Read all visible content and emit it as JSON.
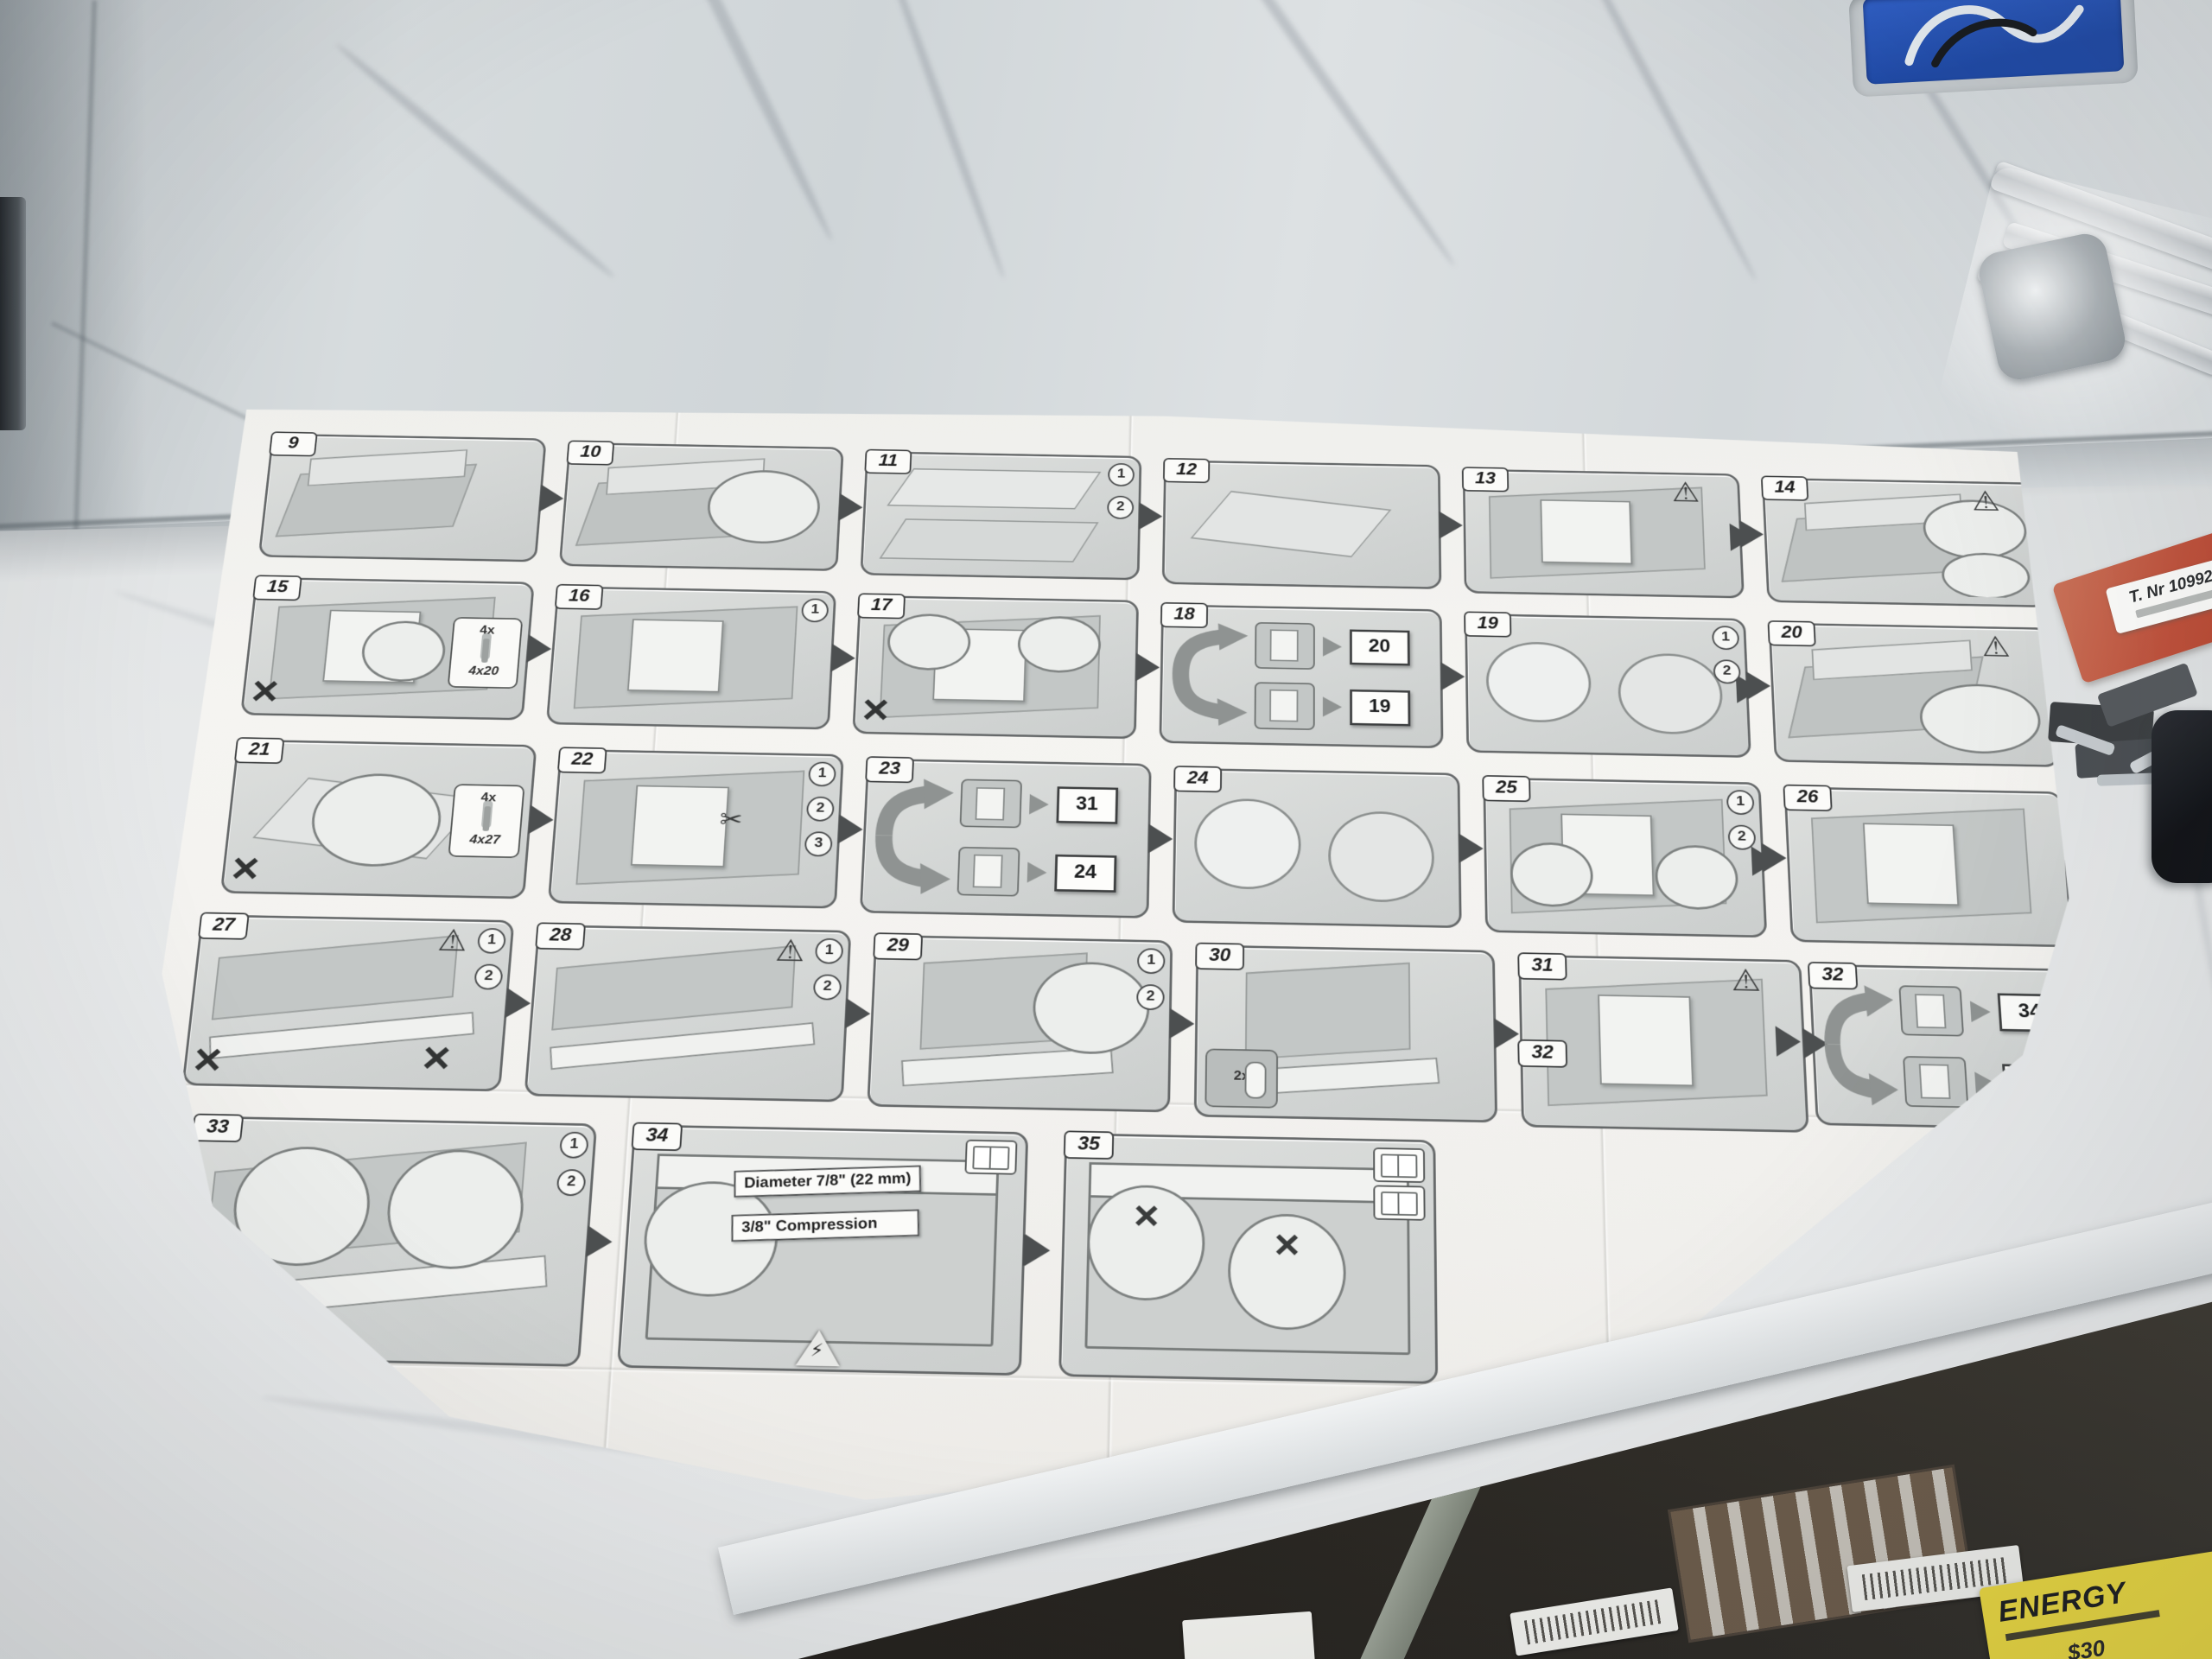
{
  "colors": {
    "outlet_blue": "#2b58c8",
    "red_card": "#c0503a",
    "energy_yellow": "#ecd93c",
    "paper": "#f3f2ef",
    "marble_base": "#dfe2e4"
  },
  "counter_items": {
    "parts_bag_label": "T. Nr 10992020",
    "energy_label_title": "ENERGY",
    "energy_label_price": "$30"
  },
  "instruction_sheet": {
    "panels": [
      {
        "id": "9",
        "row": 1,
        "pos": [
          60,
          50,
          350,
          175
        ],
        "variant": "iso"
      },
      {
        "id": "10",
        "row": 1,
        "pos": [
          445,
          55,
          350,
          175
        ],
        "variant": "iso",
        "circles": [
          {
            "r": 28,
            "x": 52,
            "y": 14,
            "w": 42,
            "h": 66
          }
        ]
      },
      {
        "id": "11",
        "row": 1,
        "pos": [
          830,
          60,
          350,
          175
        ],
        "variant": "boards",
        "steps": [
          "1",
          "2"
        ]
      },
      {
        "id": "12",
        "row": 1,
        "pos": [
          1215,
          65,
          350,
          175
        ],
        "variant": "flat"
      },
      {
        "id": "13",
        "row": 1,
        "pos": [
          1600,
          70,
          350,
          175
        ],
        "variant": "door",
        "warn": true
      },
      {
        "id": "14",
        "row": 1,
        "pos": [
          1985,
          75,
          350,
          175
        ],
        "variant": "iso",
        "warn": true,
        "circles": [
          {
            "x": 58,
            "y": 8,
            "w": 38,
            "h": 52
          },
          {
            "x": 64,
            "y": 58,
            "w": 32,
            "h": 40
          }
        ]
      },
      {
        "id": "15",
        "row": 2,
        "pos": [
          60,
          260,
          350,
          190
        ],
        "variant": "door",
        "xmark": 1,
        "screwbox": [
          "4x",
          "4x20"
        ],
        "circles": [
          {
            "x": 40,
            "y": 26,
            "w": 30,
            "h": 48
          }
        ]
      },
      {
        "id": "16",
        "row": 2,
        "pos": [
          445,
          265,
          350,
          190
        ],
        "variant": "door",
        "steps": [
          "1"
        ]
      },
      {
        "id": "17",
        "row": 2,
        "pos": [
          830,
          270,
          350,
          190
        ],
        "variant": "door",
        "xmark": 1,
        "circles": [
          {
            "x": 8,
            "y": 6,
            "w": 30,
            "h": 44
          },
          {
            "x": 58,
            "y": 6,
            "w": 30,
            "h": 44
          }
        ]
      },
      {
        "id": "18",
        "row": 2,
        "pos": [
          1215,
          275,
          350,
          190
        ],
        "variant": "fork",
        "refs": [
          "20",
          "19"
        ]
      },
      {
        "id": "19",
        "row": 2,
        "pos": [
          1600,
          280,
          350,
          190
        ],
        "variant": "feet",
        "steps": [
          "1",
          "2"
        ]
      },
      {
        "id": "20",
        "row": 2,
        "pos": [
          1985,
          285,
          350,
          190
        ],
        "variant": "iso",
        "warn": true,
        "circles": [
          {
            "x": 52,
            "y": 40,
            "w": 44,
            "h": 54
          }
        ]
      },
      {
        "id": "21",
        "row": 3,
        "pos": [
          60,
          490,
          370,
          205
        ],
        "variant": "flat",
        "xmark": 1,
        "screwbox": [
          "4x",
          "4x27"
        ],
        "circles": [
          {
            "x": 26,
            "y": 16,
            "w": 44,
            "h": 66
          }
        ]
      },
      {
        "id": "22",
        "row": 3,
        "pos": [
          465,
          495,
          350,
          205
        ],
        "variant": "door",
        "steps": [
          "1",
          "2",
          "3"
        ],
        "scissors": true
      },
      {
        "id": "23",
        "row": 3,
        "pos": [
          850,
          500,
          350,
          205
        ],
        "variant": "fork",
        "refs": [
          "31",
          "24"
        ]
      },
      {
        "id": "24",
        "row": 3,
        "pos": [
          1235,
          505,
          350,
          205
        ],
        "variant": "feet"
      },
      {
        "id": "25",
        "row": 3,
        "pos": [
          1620,
          510,
          340,
          205
        ],
        "variant": "door",
        "steps": [
          "1",
          "2"
        ],
        "circles": [
          {
            "x": 6,
            "y": 40,
            "w": 30,
            "h": 44
          },
          {
            "x": 62,
            "y": 40,
            "w": 30,
            "h": 44
          }
        ]
      },
      {
        "id": "26",
        "row": 3,
        "pos": [
          1995,
          515,
          340,
          205
        ],
        "variant": "door"
      },
      {
        "id": "27",
        "row": 4,
        "pos": [
          40,
          730,
          380,
          220
        ],
        "variant": "strip",
        "steps": [
          "1",
          "2"
        ],
        "warn": true,
        "xmark": 2
      },
      {
        "id": "28",
        "row": 4,
        "pos": [
          455,
          735,
          380,
          220
        ],
        "variant": "strip",
        "steps": [
          "1",
          "2"
        ],
        "warn": true
      },
      {
        "id": "29",
        "row": 4,
        "pos": [
          870,
          740,
          360,
          220
        ],
        "variant": "kick",
        "steps": [
          "1",
          "2"
        ],
        "circles": [
          {
            "x": 54,
            "y": 8,
            "w": 40,
            "h": 58
          }
        ]
      },
      {
        "id": "30",
        "row": 4,
        "pos": [
          1265,
          745,
          360,
          220
        ],
        "variant": "kick",
        "partsbox": "2x"
      },
      {
        "id": "31",
        "row": 4,
        "pos": [
          1660,
          750,
          340,
          220
        ],
        "variant": "door",
        "warn": true,
        "badge2": "32"
      },
      {
        "id": "32",
        "row": 4,
        "pos": [
          2015,
          755,
          320,
          205
        ],
        "variant": "fork",
        "refs": [
          "34",
          "33"
        ]
      },
      {
        "id": "33",
        "row": 5,
        "pos": [
          60,
          995,
          480,
          300
        ],
        "variant": "strip",
        "steps": [
          "1",
          "2"
        ],
        "circles": [
          {
            "x": 10,
            "y": 8,
            "w": 34,
            "h": 52
          },
          {
            "x": 50,
            "y": 8,
            "w": 34,
            "h": 52
          }
        ]
      },
      {
        "id": "34",
        "row": 5,
        "pos": [
          590,
          995,
          470,
          300
        ],
        "variant": "sink",
        "texts": [
          "Diameter 7/8\" (22 mm)",
          "3/8\" Compression"
        ],
        "book": 1,
        "elec": true,
        "circles": [
          {
            "x": 2,
            "y": 20,
            "w": 34,
            "h": 50
          }
        ]
      },
      {
        "id": "35",
        "row": 5,
        "pos": [
          1110,
          995,
          440,
          300
        ],
        "variant": "sink",
        "book": 2,
        "circles": [
          {
            "x": 4,
            "y": 18,
            "w": 32,
            "h": 50,
            "crossed": true
          },
          {
            "x": 44,
            "y": 30,
            "w": 32,
            "h": 50,
            "crossed": true
          }
        ]
      }
    ]
  }
}
